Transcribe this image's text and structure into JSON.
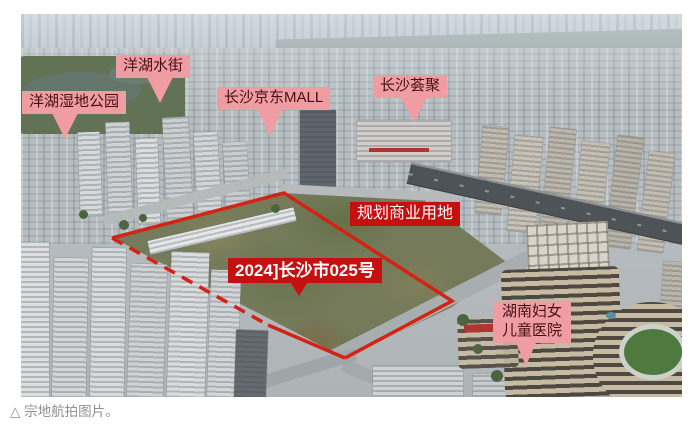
{
  "caption": {
    "text": "△ 宗地航拍图片。"
  },
  "photo": {
    "labels": {
      "wetland_park": {
        "text": "洋湖湿地公园"
      },
      "water_street": {
        "text": "洋湖水街"
      },
      "jd_mall": {
        "text": "长沙京东MALL"
      },
      "huiju": {
        "text": "长沙荟聚"
      },
      "planned_commercial": {
        "text": "规划商业用地"
      },
      "parcel_number": {
        "text": "2024]长沙市025号"
      },
      "hospital": {
        "line1": "湖南妇女",
        "line2": "儿童医院"
      }
    },
    "colors": {
      "pink_label_bg": "#f09ca3",
      "pink_label_text": "#441016",
      "red_label_bg": "#c6100f",
      "red_label_text": "#ffffff",
      "parcel_outline": "#d32314",
      "caption_text": "#8f8f8f"
    }
  }
}
